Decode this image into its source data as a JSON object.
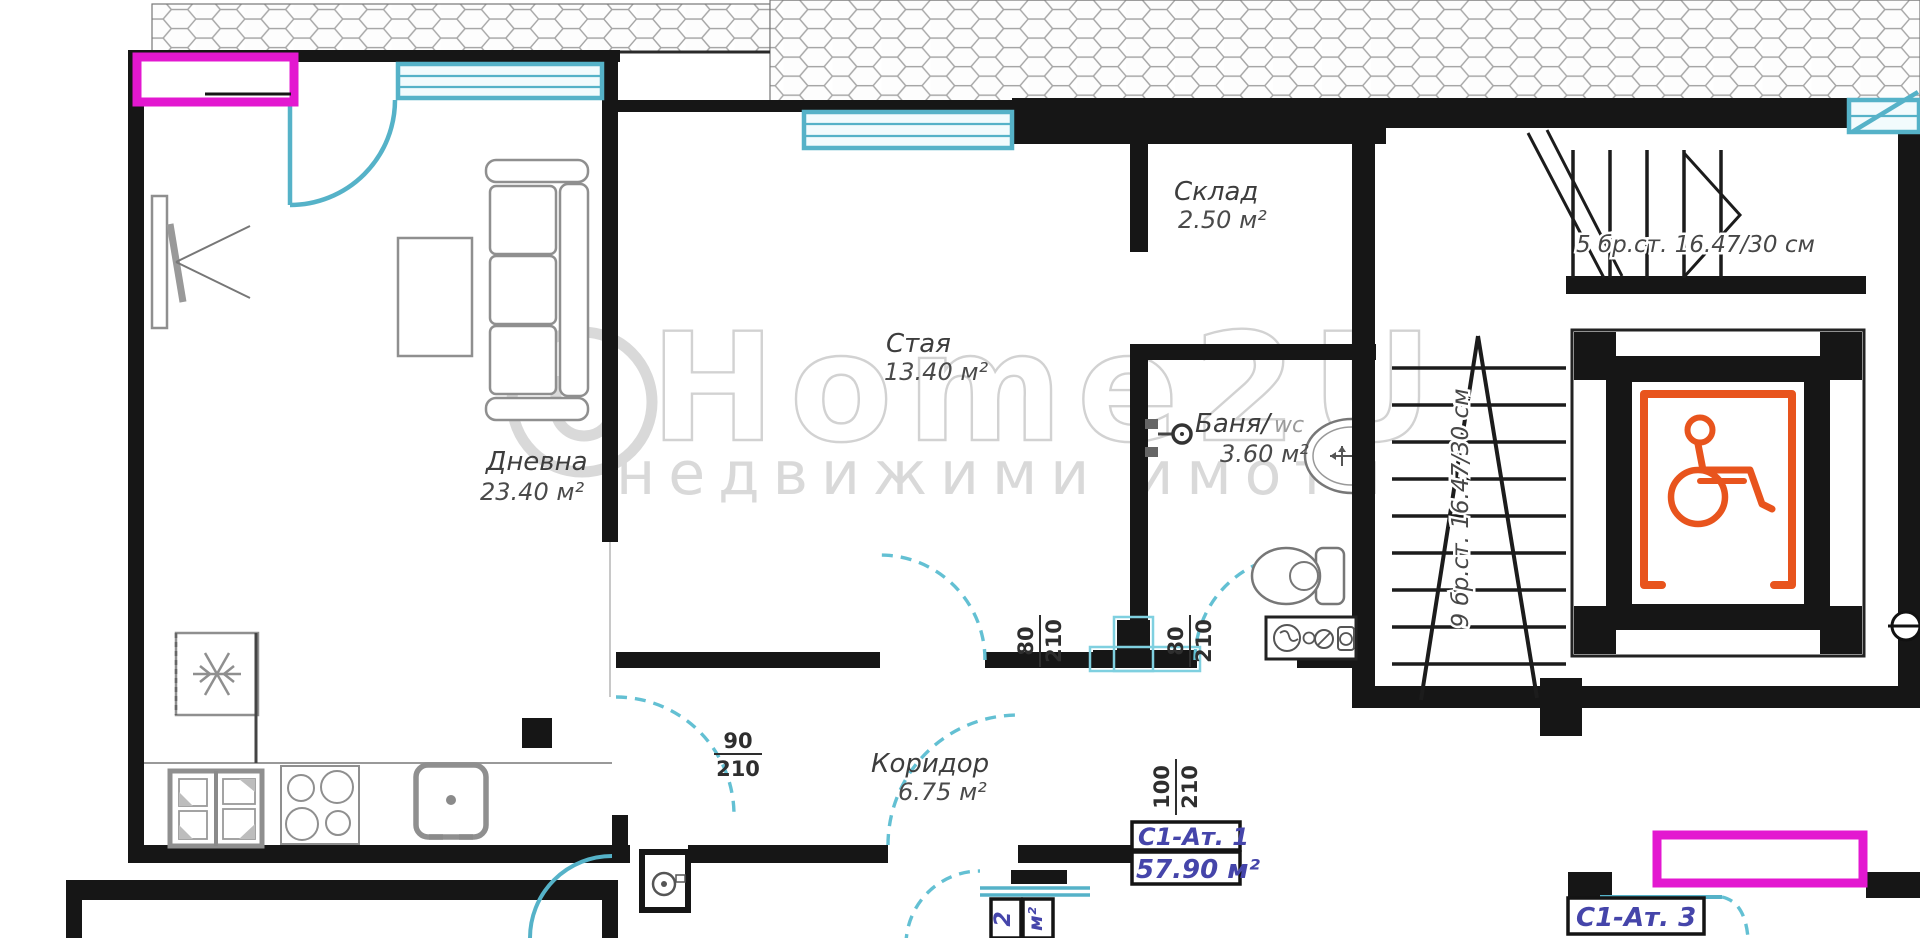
{
  "plan": {
    "rooms": [
      {
        "name": "Дневна",
        "area": "23.40 м²"
      },
      {
        "name": "Стая",
        "area": "13.40 м²"
      },
      {
        "name": "Склад",
        "area": "2.50 м²"
      },
      {
        "name": "Баня/",
        "suffix": "wc",
        "area": "3.60 м²"
      },
      {
        "name": "Коридор",
        "area": "6.75 м²"
      }
    ],
    "doors": {
      "livingroom": {
        "num": "90",
        "den": "210"
      },
      "staya": {
        "num": "80",
        "den": "210"
      },
      "bath": {
        "num": "80",
        "den": "210"
      },
      "entrance": {
        "num": "100",
        "den": "210"
      }
    },
    "stairs": {
      "upper_flight": "5 бр.ст. 16.47/30 см",
      "lower_flight": "9 бр.ст. 16.47/30 см"
    },
    "apartments": {
      "current": {
        "code": "С1-Ат. 1",
        "area": "57.90 м²"
      },
      "adjacent_below": {
        "code_part": "2",
        "area_part": "м²"
      },
      "adjacent_right": {
        "code": "С1-Ат. 3"
      }
    },
    "watermark": {
      "brand": "Home2U",
      "tagline": "недвижими имоти"
    },
    "colors": {
      "wall": "#161616",
      "window_cyan": "#55b2c8",
      "magenta": "#e318d0",
      "accent_orange": "#e8541d",
      "label_purple": "#4545aa",
      "watermark_gray": "#d7d7d7"
    }
  }
}
